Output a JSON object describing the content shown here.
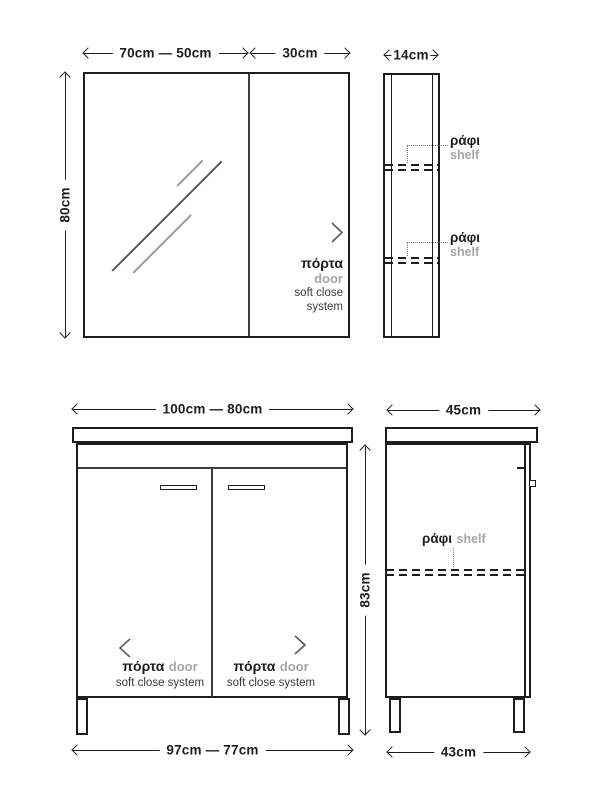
{
  "colors": {
    "line": "#1d1d1b",
    "secondary_text": "#3a3a3a",
    "gray_text": "#a6a6a6",
    "chevron": "#595959"
  },
  "mirror_front": {
    "dim_width_doors": "70cm — 50cm",
    "dim_width_side": "30cm",
    "dim_height": "80cm",
    "door": {
      "label_gr": "πόρτα",
      "label_en": "door",
      "feature_line1": "soft close",
      "feature_line2": "system"
    }
  },
  "mirror_side": {
    "dim_depth": "14cm",
    "shelves": [
      {
        "label_gr": "ράφι",
        "label_en": "shelf"
      },
      {
        "label_gr": "ράφι",
        "label_en": "shelf"
      }
    ]
  },
  "vanity_front": {
    "dim_width_top": "100cm — 80cm",
    "dim_width_bottom": "97cm — 77cm",
    "dim_height": "83cm",
    "doors": [
      {
        "label_gr": "πόρτα",
        "label_en": "door",
        "feature": "soft close system"
      },
      {
        "label_gr": "πόρτα",
        "label_en": "door",
        "feature": "soft close system"
      }
    ]
  },
  "vanity_side": {
    "dim_depth_top": "45cm",
    "dim_depth_bottom": "43cm",
    "shelf": {
      "label_gr": "ράφι",
      "label_en": "shelf"
    }
  }
}
